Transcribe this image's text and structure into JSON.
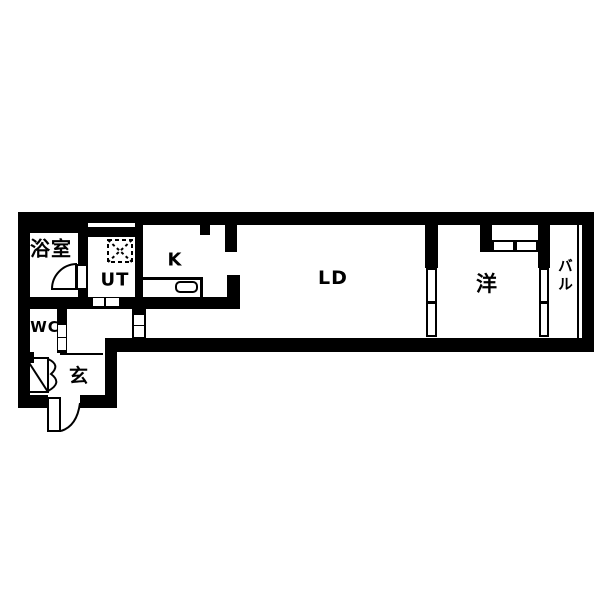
{
  "floorplan": {
    "canvas": {
      "width": 600,
      "height": 600
    },
    "colors": {
      "wall": "#000000",
      "floor": "#ffffff"
    },
    "rooms": [
      {
        "id": "bath",
        "label": "浴室",
        "x": 51,
        "y": 249,
        "font": 20,
        "vertical": false
      },
      {
        "id": "ut",
        "label": "UT",
        "x": 115,
        "y": 281,
        "font": 18,
        "vertical": false
      },
      {
        "id": "kitchen",
        "label": "K",
        "x": 175,
        "y": 261,
        "font": 18,
        "vertical": false
      },
      {
        "id": "living-dining",
        "label": "LD",
        "x": 333,
        "y": 279,
        "font": 19,
        "vertical": false
      },
      {
        "id": "western-room",
        "label": "洋",
        "x": 487,
        "y": 284,
        "font": 21,
        "vertical": false
      },
      {
        "id": "balcony",
        "label": "バル",
        "x": 564,
        "y": 276,
        "font": 15,
        "vertical": true
      },
      {
        "id": "wc",
        "label": "WC",
        "x": 45,
        "y": 328,
        "font": 15,
        "vertical": false
      },
      {
        "id": "entrance",
        "label": "玄",
        "x": 79,
        "y": 377,
        "font": 19,
        "vertical": false
      }
    ],
    "walls": [
      {
        "id": "top-wall-left",
        "x": 18,
        "y": 212,
        "w": 70,
        "h": 21
      },
      {
        "id": "top-wall-ut-outer",
        "x": 88,
        "y": 212,
        "w": 47,
        "h": 11
      },
      {
        "id": "ut-window-sill",
        "x": 88,
        "y": 227,
        "w": 47,
        "h": 10
      },
      {
        "id": "top-wall-main",
        "x": 135,
        "y": 212,
        "w": 459,
        "h": 13
      },
      {
        "id": "left-outer-wall",
        "x": 18,
        "y": 212,
        "w": 12,
        "h": 196
      },
      {
        "id": "right-outer-wall",
        "x": 582,
        "y": 212,
        "w": 12,
        "h": 140
      },
      {
        "id": "bottom-wall-main",
        "x": 105,
        "y": 338,
        "w": 489,
        "h": 14
      },
      {
        "id": "entry-bottom-wall-left",
        "x": 18,
        "y": 395,
        "w": 30,
        "h": 13
      },
      {
        "id": "entry-bottom-wall-right",
        "x": 80,
        "y": 395,
        "w": 37,
        "h": 13
      },
      {
        "id": "entry-right-outer-wall",
        "x": 105,
        "y": 338,
        "w": 12,
        "h": 70
      },
      {
        "id": "bath-right-wall-upper",
        "x": 78,
        "y": 225,
        "w": 10,
        "h": 40
      },
      {
        "id": "bath-right-wall-lower",
        "x": 78,
        "y": 290,
        "w": 10,
        "h": 10
      },
      {
        "id": "ut-kitchen-wall",
        "x": 135,
        "y": 223,
        "w": 8,
        "h": 86
      },
      {
        "id": "service-bottom-wall",
        "x": 18,
        "y": 297,
        "w": 222,
        "h": 12
      },
      {
        "id": "hall-ld-door-wall",
        "x": 132,
        "y": 309,
        "w": 14,
        "h": 29
      },
      {
        "id": "wc-right-wall",
        "x": 57,
        "y": 309,
        "w": 10,
        "h": 44
      },
      {
        "id": "wc-bottom-wall",
        "x": 18,
        "y": 352,
        "w": 16,
        "h": 11
      },
      {
        "id": "kitchen-ld-wall-stub",
        "x": 227,
        "y": 275,
        "w": 13,
        "h": 34
      },
      {
        "id": "kitchen-column",
        "x": 225,
        "y": 223,
        "w": 12,
        "h": 29
      },
      {
        "id": "kitchen-top-stub",
        "x": 200,
        "y": 223,
        "w": 10,
        "h": 12
      },
      {
        "id": "ld-western-wall-upper",
        "x": 425,
        "y": 225,
        "w": 13,
        "h": 43
      },
      {
        "id": "closet-left-stub",
        "x": 480,
        "y": 225,
        "w": 12,
        "h": 27
      },
      {
        "id": "western-balcony-wall",
        "x": 538,
        "y": 213,
        "w": 12,
        "h": 55
      },
      {
        "id": "balcony-rail-line",
        "x": 577,
        "y": 225,
        "w": 2,
        "h": 113
      },
      {
        "id": "entry-step-line",
        "x": 60,
        "y": 353,
        "w": 43,
        "h": 2
      }
    ],
    "door_insets": [
      {
        "id": "ut-sliding-door-panel-1",
        "x": 93,
        "y": 298,
        "w": 11,
        "h": 8
      },
      {
        "id": "ut-sliding-door-panel-2",
        "x": 106,
        "y": 298,
        "w": 13,
        "h": 8
      },
      {
        "id": "hall-door-panel-1",
        "x": 134,
        "y": 315,
        "w": 10,
        "h": 10
      },
      {
        "id": "hall-door-panel-2",
        "x": 134,
        "y": 326,
        "w": 10,
        "h": 11
      },
      {
        "id": "wc-door-panel-1",
        "x": 58,
        "y": 325,
        "w": 8,
        "h": 12
      },
      {
        "id": "wc-door-panel-2",
        "x": 58,
        "y": 338,
        "w": 8,
        "h": 12
      }
    ],
    "outlined_panels": [
      {
        "id": "bath-door-leaf",
        "x": 76,
        "y": 264,
        "w": 12,
        "h": 26
      },
      {
        "id": "ld-western-door-panel-1",
        "x": 426,
        "y": 268,
        "w": 11,
        "h": 35
      },
      {
        "id": "ld-western-door-panel-2",
        "x": 426,
        "y": 302,
        "w": 11,
        "h": 35
      },
      {
        "id": "balcony-window-panel-1",
        "x": 539,
        "y": 268,
        "w": 10,
        "h": 35
      },
      {
        "id": "balcony-window-panel-2",
        "x": 539,
        "y": 302,
        "w": 10,
        "h": 35
      },
      {
        "id": "closet-door-panel-1",
        "x": 492,
        "y": 240,
        "w": 23,
        "h": 12
      },
      {
        "id": "closet-door-panel-2",
        "x": 515,
        "y": 240,
        "w": 23,
        "h": 12
      },
      {
        "id": "entry-door-leaf",
        "x": 47,
        "y": 397,
        "w": 14,
        "h": 35
      },
      {
        "id": "kitchen-sink",
        "x": 175,
        "y": 281,
        "w": 23,
        "h": 12,
        "r": 5
      }
    ],
    "kitchen_counter": {
      "id": "kitchen-counter",
      "x": 143,
      "y": 277,
      "w": 60,
      "h": 20
    },
    "paths": [
      {
        "id": "bath-door-swing",
        "d": "M 76 264 L 76 289 L 52 289 A 25 25 0 0 1 76 264 Z",
        "fill": "#ffffff"
      },
      {
        "id": "entry-door-swing",
        "d": "M 61 431 Q 77 426 80 403"
      },
      {
        "id": "wc-door-frame",
        "d": "M 26 358 L 48 358 L 48 392 L 26 392 Z"
      },
      {
        "id": "wc-door-diagonal",
        "d": "M 26 358 L 48 392"
      },
      {
        "id": "wc-door-fold",
        "d": "M 48 359 Q 61 365 51 374 Q 63 383 48 391"
      },
      {
        "id": "washer-outline",
        "d": "M 108 240 H 132 V 262 H 108 Z",
        "dash": "4 3"
      },
      {
        "id": "washer-cross",
        "d": "M 108 240 L 132 262 M 132 240 L 108 262",
        "dash": "3 3"
      }
    ]
  }
}
